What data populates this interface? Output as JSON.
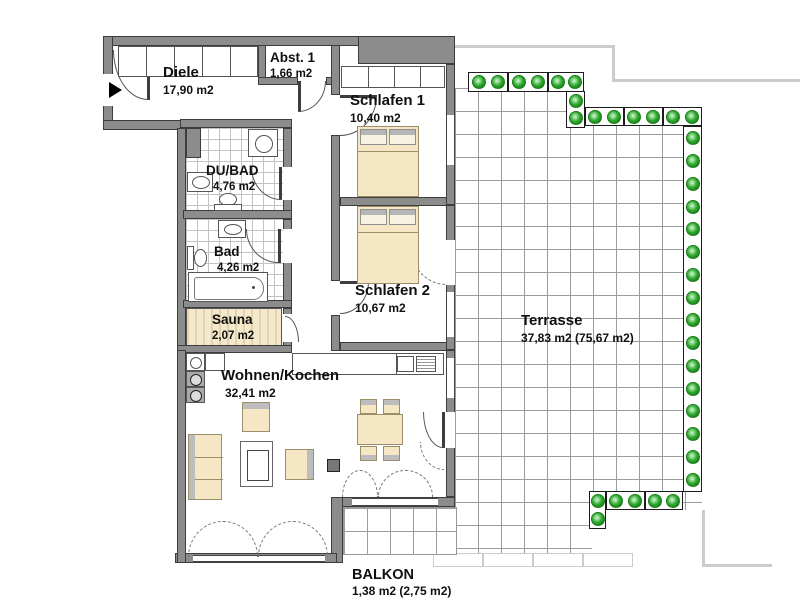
{
  "plan": {
    "rooms": {
      "diele": {
        "name": "Diele",
        "area": "17,90 m2"
      },
      "abst1": {
        "name": "Abst. 1",
        "area": "1,66 m2"
      },
      "schlafen1": {
        "name": "Schlafen 1",
        "area": "10,40 m2"
      },
      "dubad": {
        "name": "DU/BAD",
        "area": "4,76 m2"
      },
      "bad": {
        "name": "Bad",
        "area": "4,26 m2"
      },
      "sauna": {
        "name": "Sauna",
        "area": "2,07 m2"
      },
      "schlafen2": {
        "name": "Schlafen 2",
        "area": "10,67 m2"
      },
      "wohnen_kochen": {
        "name": "Wohnen/Kochen",
        "area": "32,41 m2"
      },
      "terrasse": {
        "name": "Terrasse",
        "area": "37,83 m2 (75,67 m2)"
      },
      "balkon": {
        "name": "BALKON",
        "area": "1,38 m2 (2,75 m2)"
      }
    },
    "colors": {
      "wall": "#8c8c8c",
      "wall-line": "#3d3d3d",
      "furniture": "#f5e7c4",
      "furniture-line": "#9a8f6a",
      "plant-green": "#2fa82f",
      "tile-line": "#c3c3c3",
      "terrace-line": "#9c9c9c",
      "outline-light": "#cccccc",
      "sauna-wood": "#f3e9cf"
    }
  }
}
